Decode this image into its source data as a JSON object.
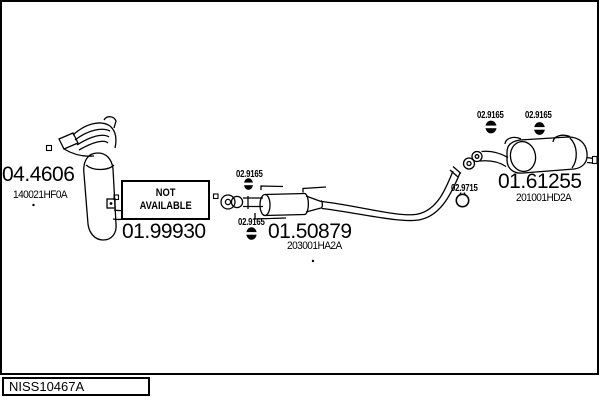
{
  "diagram": {
    "id": "NISS10467A",
    "parts": {
      "manifold_catalyst": {
        "code": "04.4606",
        "oem": "140021HF0A"
      },
      "front_pipe": {
        "code": "01.99930",
        "availability_line1": "NOT",
        "availability_line2": "AVAILABLE"
      },
      "center_silencer": {
        "code": "01.50879",
        "oem": "203001HA2A"
      },
      "rear_silencer": {
        "code": "01.61255",
        "oem": "201001HD2A"
      },
      "rubber_hanger": {
        "code": "02.9165"
      },
      "gasket_ring": {
        "code": "02.9715"
      }
    }
  },
  "colors": {
    "line": "#000000",
    "background": "#ffffff"
  }
}
